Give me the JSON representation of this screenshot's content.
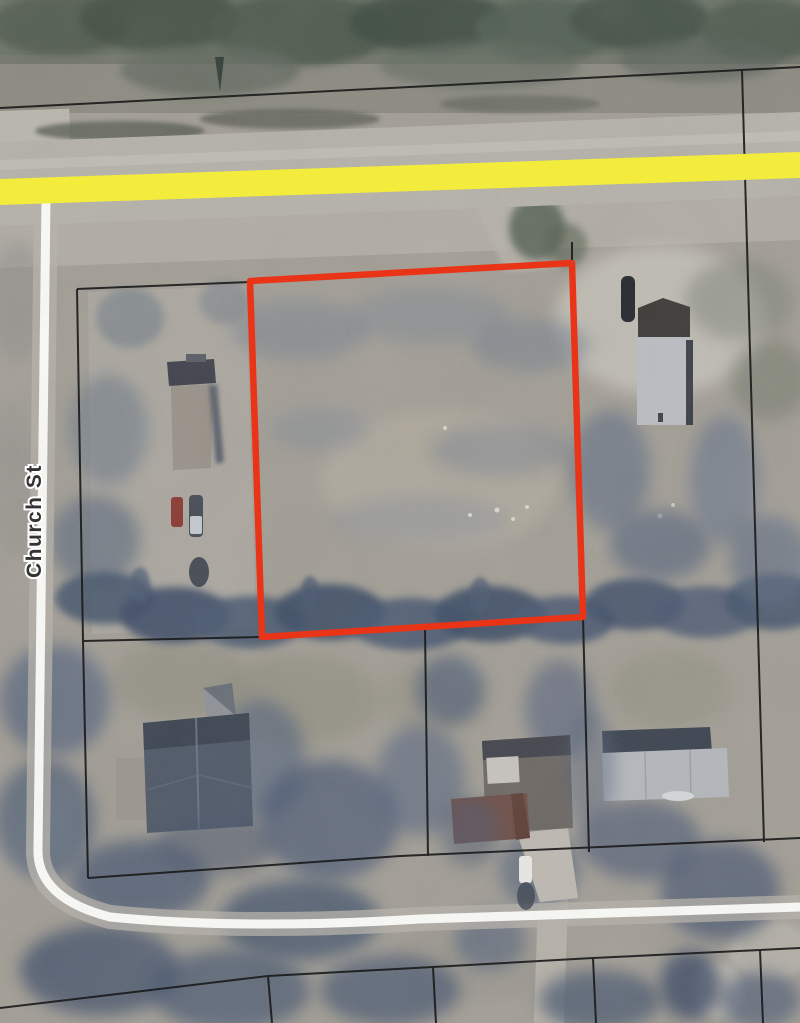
{
  "map": {
    "street_label": "Church St",
    "colors": {
      "parcel_highlight": "#e93418",
      "road_highlight": "#f3ec3c",
      "boundary_line": "#1a1a1a",
      "road_surface": "#fbfbf8"
    }
  }
}
